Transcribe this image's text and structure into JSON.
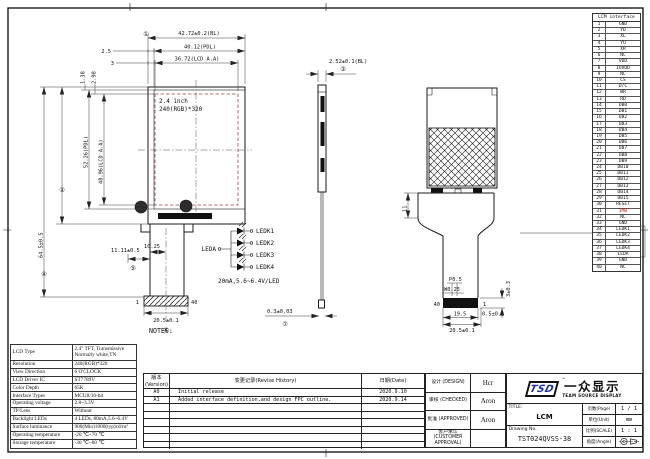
{
  "display": {
    "size_label": "2.4 inch",
    "res_label": "240(RGB)*320"
  },
  "dims": {
    "front_top_bl": "42.72±0.2(BL)",
    "front_top_bl_no": "①",
    "front_top_pdl": "40.12(PDL)",
    "front_top_pdl_off": "2.5",
    "front_top_aa": "36.72(LCD A.A)",
    "front_top_aa_off": "3",
    "front_off_138": "1.38",
    "front_off_298": "2.98",
    "front_left_645": "64.5±0.5",
    "front_left_645_no": "④",
    "front_left_bl": "60.26±0.2(BL)",
    "front_left_bl_no": "②",
    "front_left_pdl": "52.26(PDL)",
    "front_left_aa": "48.96(LCD A.A)",
    "front_1025": "10.25",
    "front_1111": "11.11±0.5",
    "front_1111_no": "⑤",
    "front_conn": "20.5±0.1",
    "front_conn_no": "⑥",
    "front_pin1": "1",
    "front_pin40": "40",
    "side_bl": "2.52±0.1(BL)",
    "side_bl_no": "③",
    "side_fpc": "0.3±0.03",
    "side_fpc_no": "⑦",
    "back_11": "11",
    "back_p": "P0.5",
    "back_w": "W0.25",
    "back_pin40": "40",
    "back_pin1": "1",
    "back_195": "19.5",
    "back_05": "0.5±0.1",
    "back_205": "20.5±0.1",
    "back_3": "3±0.3"
  },
  "led_circuit": {
    "anode": "LEDA",
    "cathodes": [
      "LEDK1",
      "LEDK2",
      "LEDK3",
      "LEDK4"
    ],
    "rating": "20mA,5.6~6.4V/LED"
  },
  "notes": {
    "title": "NOTES:",
    "lines": [
      "1.GENERAL TOLERANCE:±0.2",
      "2.( )REFERENCE DIMENSION",
      "3.Important dimension: ①~⑦"
    ]
  },
  "im0_note": {
    "lines": [
      "IM0=0, MCU16-bit,DB[0:15]",
      "IM0=1, MCU8-bit,DB[8:15]",
      "(IM0 must be connect to",
      "GND[0] or IOVDD[1])"
    ]
  },
  "pin_table": {
    "header": "LCM interface",
    "pins": [
      {
        "no": "1",
        "name": "GND"
      },
      {
        "no": "2",
        "name": "YD"
      },
      {
        "no": "3",
        "name": "XL"
      },
      {
        "no": "4",
        "name": "YU"
      },
      {
        "no": "5",
        "name": "XR"
      },
      {
        "no": "6",
        "name": "NC"
      },
      {
        "no": "7",
        "name": "VDD"
      },
      {
        "no": "8",
        "name": "IOVDD"
      },
      {
        "no": "9",
        "name": "NC"
      },
      {
        "no": "10",
        "name": "CS"
      },
      {
        "no": "11",
        "name": "D/C"
      },
      {
        "no": "12",
        "name": "WR"
      },
      {
        "no": "13",
        "name": "RD"
      },
      {
        "no": "14",
        "name": "DB0"
      },
      {
        "no": "15",
        "name": "DB1"
      },
      {
        "no": "16",
        "name": "DB2"
      },
      {
        "no": "17",
        "name": "DB3"
      },
      {
        "no": "18",
        "name": "DB4"
      },
      {
        "no": "19",
        "name": "DB5"
      },
      {
        "no": "20",
        "name": "DB6"
      },
      {
        "no": "21",
        "name": "DB7"
      },
      {
        "no": "22",
        "name": "DB8"
      },
      {
        "no": "23",
        "name": "DB9"
      },
      {
        "no": "24",
        "name": "DB10"
      },
      {
        "no": "25",
        "name": "DB11"
      },
      {
        "no": "26",
        "name": "DB12"
      },
      {
        "no": "27",
        "name": "DB13"
      },
      {
        "no": "28",
        "name": "DB14"
      },
      {
        "no": "29",
        "name": "DB15"
      },
      {
        "no": "30",
        "name": "RESET"
      },
      {
        "no": "31",
        "name": "IM0",
        "cls": "red"
      },
      {
        "no": "32",
        "name": "NC"
      },
      {
        "no": "33",
        "name": "GND"
      },
      {
        "no": "34",
        "name": "LEDK1"
      },
      {
        "no": "35",
        "name": "LEDK2"
      },
      {
        "no": "36",
        "name": "LEDK3"
      },
      {
        "no": "37",
        "name": "LEDK4"
      },
      {
        "no": "38",
        "name": "LEDA"
      },
      {
        "no": "39",
        "name": "GND"
      },
      {
        "no": "40",
        "name": "NC"
      }
    ]
  },
  "spec_table": {
    "rows": [
      {
        "label": "LCD Type",
        "value": "2.4\" TFT, Transmissive\nNormally white,TN"
      },
      {
        "label": "Resolution",
        "value": "240(RGB)*320"
      },
      {
        "label": "View Direction",
        "value": "6 O'CLOCK"
      },
      {
        "label": "LCD Driver IC",
        "value": "ST7789V"
      },
      {
        "label": "Color Depth",
        "value": "65K"
      },
      {
        "label": "Interface Types",
        "value": "MCU8/16-bit"
      },
      {
        "label": "Operating voltage",
        "value": "2.8~3.3V"
      },
      {
        "label": "TP/Lens",
        "value": "Without"
      },
      {
        "label": "Backlight LEDs",
        "value": "4 LEDs, 80mA,5.6~6.4V"
      },
      {
        "label": "Surface luminance",
        "value": "900(Min)1000(typ)cd/m²"
      },
      {
        "label": "Operating temperature",
        "value": "-20 ℃~70 ℃"
      },
      {
        "label": "Storage temperature",
        "value": "-30 ℃~80 ℃"
      }
    ]
  },
  "revision_table": {
    "headers": {
      "version": "版本\n(Version)",
      "history": "变更记录(Revise History)",
      "date": "日期(Date)"
    },
    "rows": [
      {
        "ver": "A0",
        "desc": "Initial release",
        "date": "2020.9.10"
      },
      {
        "ver": "A1",
        "desc": "Added interface definition,and design FPC outline.",
        "date": "2020.9.14"
      },
      {
        "ver": "",
        "desc": "",
        "date": ""
      },
      {
        "ver": "",
        "desc": "",
        "date": ""
      },
      {
        "ver": "",
        "desc": "",
        "date": ""
      },
      {
        "ver": "",
        "desc": "",
        "date": ""
      },
      {
        "ver": "",
        "desc": "",
        "date": ""
      },
      {
        "ver": "",
        "desc": "",
        "date": ""
      }
    ]
  },
  "approvals": {
    "rows": [
      {
        "label": "设计 (DESIGN)",
        "value": "Hcr"
      },
      {
        "label": "审核 (CHECKED)",
        "value": "Aron"
      },
      {
        "label": "批准 (APPROVED)",
        "value": "Aron"
      },
      {
        "label": "客户承认\n(CUSTOMER APPROVAL)",
        "value": ""
      }
    ]
  },
  "title_block": {
    "logo_tsd": "TSD",
    "logo_tm": "™",
    "logo_cn": "一众显示",
    "logo_en": "TEAM SOURCE DISPLAY",
    "title_label": "TITLE:",
    "title_value": "LCM",
    "drawing_label": "Drawing No.",
    "drawing_value": "TST024QVSS-38",
    "page_label": "页数(Page)",
    "page_value": "1 / 1",
    "unit_label": "单位(Unit)",
    "unit_value": "mm",
    "scale_label": "比例(SCALE)",
    "scale_value": "1 : 1",
    "angle_label": "角度(Angle)"
  },
  "colors": {
    "pin_highlight": "#cc1111",
    "aa_border": "#9b4a4a",
    "logo_blue": "#1c2f9e"
  }
}
